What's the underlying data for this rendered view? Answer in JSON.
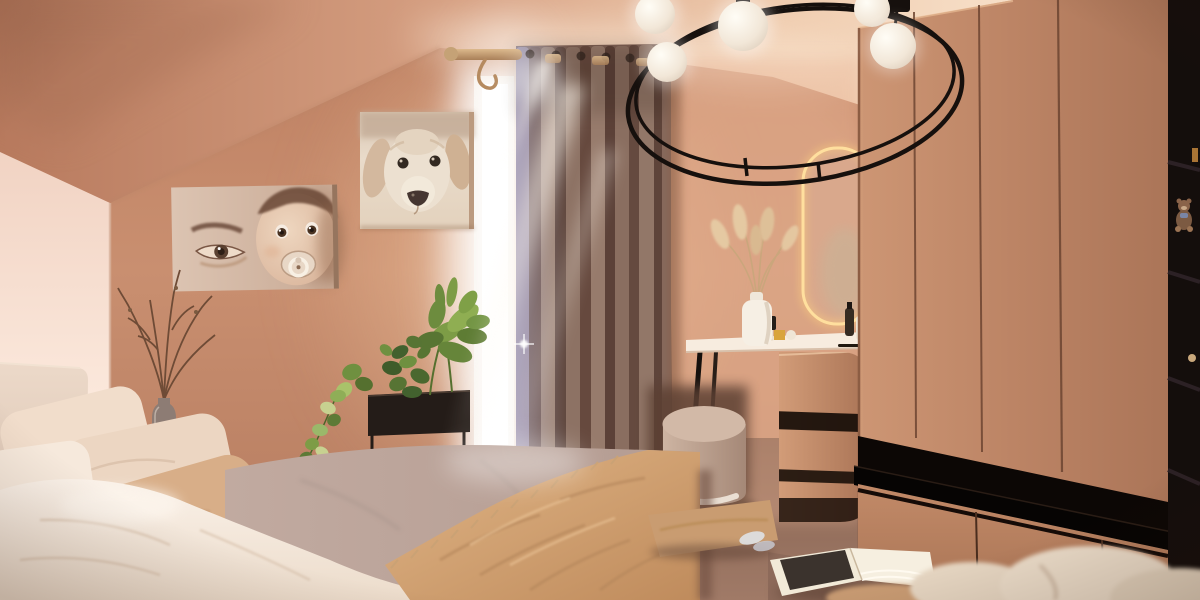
{
  "scene": {
    "type": "bedroom-interior-render",
    "room": "attic bedroom with sloped ceiling, warm terracotta walls",
    "objects": [
      {
        "name": "sloped-ceiling",
        "desc": "attic ceiling slope upper left"
      },
      {
        "name": "back-wall",
        "desc": "terracotta plaster wall"
      },
      {
        "name": "picture-baby",
        "desc": "sepia canvas print of baby with pacifier beside adult eye"
      },
      {
        "name": "picture-dog",
        "desc": "sepia canvas print of golden retriever dog head"
      },
      {
        "name": "window",
        "desc": "bright daylight window behind curtain"
      },
      {
        "name": "curtain",
        "desc": "floor-length taupe grommet curtain on wooden rod"
      },
      {
        "name": "curtain-rod",
        "desc": "wooden curtain rod with hook"
      },
      {
        "name": "chandelier",
        "desc": "black ring chandelier with white globe bulbs",
        "bulb_count": 5
      },
      {
        "name": "wardrobe",
        "desc": "tan flat-front wardrobe with black open niche and drawers"
      },
      {
        "name": "shelf-column",
        "desc": "dark open shelving with teddy bear"
      },
      {
        "name": "vanity-mirror",
        "desc": "capsule mirror with warm LED edge"
      },
      {
        "name": "vanity-table",
        "desc": "white-top dressing table with cosmetics"
      },
      {
        "name": "pampas-vase",
        "desc": "white vase with dried pampas grass"
      },
      {
        "name": "pouf",
        "desc": "round taupe vanity stool"
      },
      {
        "name": "vanity-cabinet",
        "desc": "rounded tan drawer cabinet"
      },
      {
        "name": "bed",
        "desc": "bed with cream pillows, white sheets, mauve duvet, tan fringed throw"
      },
      {
        "name": "nightstand",
        "desc": "white bedside table with dried-branch vase"
      },
      {
        "name": "planter",
        "desc": "black standing planter box with green plants and trailing pothos"
      },
      {
        "name": "floor-cushion",
        "desc": "tan cushion on carpet"
      },
      {
        "name": "open-book",
        "desc": "open magazine on floor"
      },
      {
        "name": "bedding-pile",
        "desc": "cream bedding in lower right corner"
      },
      {
        "name": "god-rays",
        "desc": "sun rays streaming across curtain onto bed"
      }
    ]
  },
  "palette": {
    "wallTop": "#bd7f61",
    "wallMid": "#c98f70",
    "wallBottom": "#b47a5e",
    "wallGlow": "#f2c7a0",
    "ceilDark": "#b87a5e",
    "ceilLight": "#f8e2cc",
    "leftWallTop": "#f1d3c3",
    "leftWallBottom": "#fdf4ed",
    "floorDark": "#83604f",
    "floorLight": "#a07a67",
    "wardrobe1": "#cd9674",
    "wardrobe2": "#ab7558",
    "seamBrown": "#6d4531",
    "nicheBlack": "#0c0705",
    "shelfBlack": "#060403",
    "columnBlack": "#140e0c",
    "curtainBase": "#7b5e52",
    "curtainDark": "#5f463c",
    "curtainMid": "#8d7264",
    "curtainLight": "#a08573",
    "curtainSheen": "#9c8a99",
    "windowWhite": "#ffffff",
    "frameCream": "#f1e7dc",
    "rodWood": "#c8a273",
    "canvasCream": "#e9d6c6",
    "sepiaDark": "#6b4a3a",
    "dogCream": "#ece0d0",
    "dogEar": "#d3b89e",
    "headboard": "#e6d2c2",
    "pillowCream": "#f1ddcb",
    "pillowTan": "#d8ae88",
    "sheetWhite": "#faf1e8",
    "duvetMauve": "#c1aaa0",
    "throwTan": "#d0a071",
    "fringeTan": "#caa275",
    "plantGreen": "#6f8f3f",
    "plantDark": "#42612e",
    "plantLight": "#c7d190",
    "planterBlack": "#241c18",
    "branchBrown": "#6e4b36",
    "vaseGray": "#8d7c74",
    "nightstand": "#efe0d1",
    "mirrorGlow": "#ffd27e",
    "mirrorFace": "#d9a88c",
    "pampas": "#e6cba4",
    "vanityTop": "#f7ecdf",
    "cabinet1": "#d29c78",
    "cabinet2": "#aa7456",
    "poufLight": "#d2b9a7",
    "pouf1": "#cdb4a2",
    "pouf2": "#a58877",
    "poufBase": "#eadfd3",
    "cushionTan": "#c99c71",
    "bookPage": "#f2ead8",
    "bookPhoto": "#3b332d",
    "beddingCream": "#e8d9c6",
    "chandelierBlack": "#16100d",
    "bulbWhite": "#fffdf6",
    "teddyBrown": "#8a6349"
  }
}
